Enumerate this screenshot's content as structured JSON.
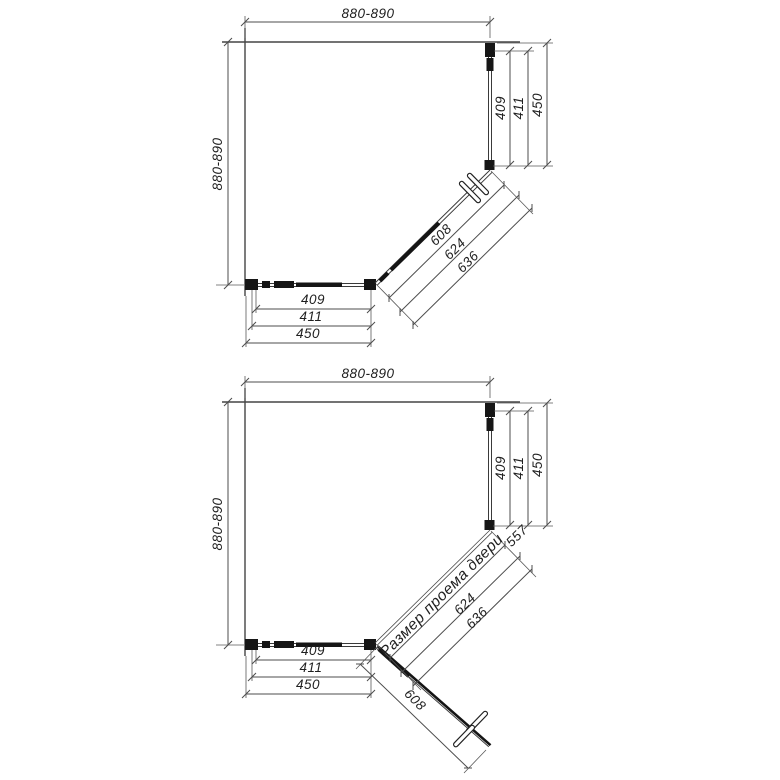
{
  "drawing": {
    "top": {
      "width": "880-890",
      "height": "880-890",
      "right": [
        "409",
        "411",
        "450"
      ],
      "bottom": [
        "409",
        "411",
        "450"
      ],
      "diagonal": [
        "608",
        "624",
        "636"
      ]
    },
    "bottom": {
      "width": "880-890",
      "height": "880-890",
      "right": [
        "409",
        "411",
        "450"
      ],
      "bottom": [
        "409",
        "411",
        "450"
      ],
      "diagonal": [
        "624",
        "636"
      ],
      "door": "608",
      "opening_label": "Размер проема двери",
      "opening_size": "557"
    }
  }
}
